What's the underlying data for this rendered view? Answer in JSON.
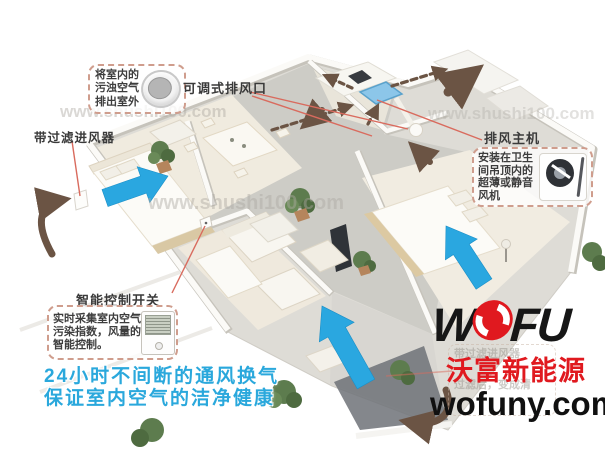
{
  "canvas": {
    "width": 605,
    "height": 452
  },
  "watermark": {
    "text": "www.shushi100.com"
  },
  "callouts": {
    "exhaust_note": {
      "lines": [
        "将室内的",
        "污浊空气",
        "排出室外"
      ]
    },
    "adjustable_vent": {
      "label": "可调式排风口"
    },
    "filter_inlet": {
      "label": "带过滤进风器"
    },
    "exhaust_host": {
      "title": "排风主机",
      "lines": [
        "安装在卫生",
        "间吊顶内的",
        "超薄或静音",
        "风机"
      ]
    },
    "smart_switch": {
      "title": "智能控制开关",
      "lines": [
        "实时采集室内空气",
        "污染指数，风量的",
        "智能控制。"
      ]
    },
    "faded_label": {
      "line_top": "带过滤进风器",
      "line_mid": "过滤后，变成清"
    }
  },
  "tagline": {
    "line1": "24小时不间断的通风换气",
    "line2": "保证室内空气的洁净健康"
  },
  "brand": {
    "logo_left": "W",
    "logo_right": "FU",
    "name": "沃富新能源",
    "website": "wofuny.com"
  },
  "legend_colors": {
    "fresh_air_arrow": "#2aa7e0",
    "exhaust_air_arrow": "#6b5444",
    "leader_line": "#d96b5e",
    "brand_red": "#e0191f",
    "tagline_blue": "#2aa8dc"
  },
  "icons": {
    "vent_device": "round-exhaust-vent",
    "fan_device": "ultra-thin-silent-fan",
    "thermostat_device": "smart-control-panel",
    "logo_o": "wofu-red-swirl"
  }
}
